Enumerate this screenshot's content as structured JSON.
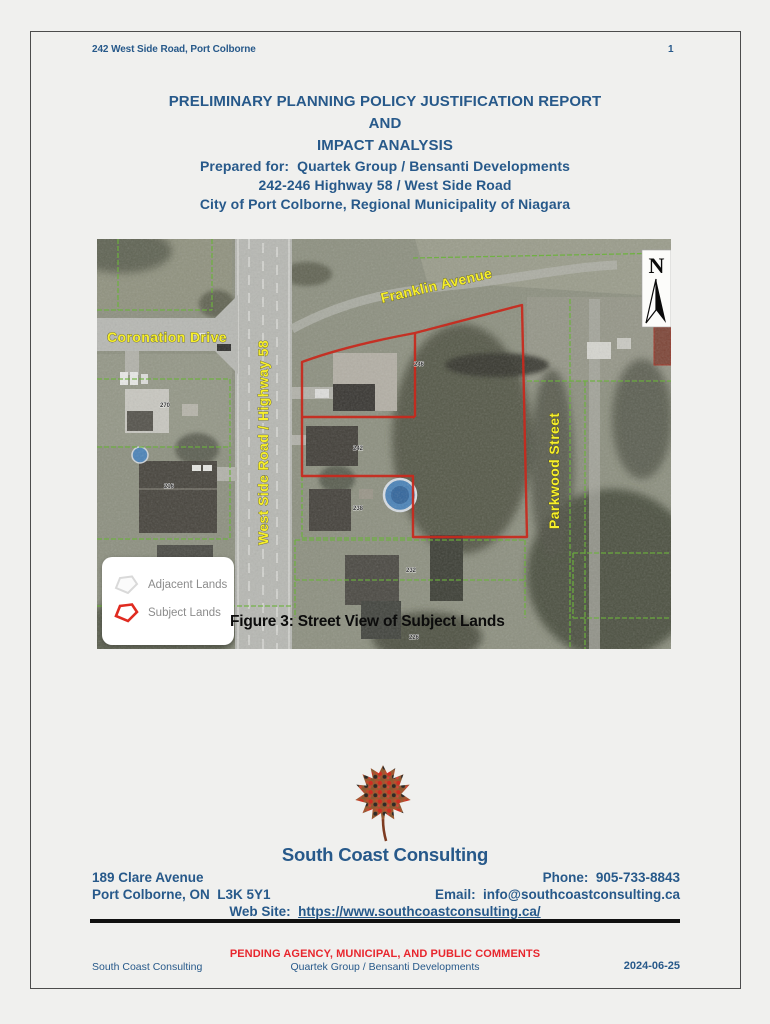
{
  "header": {
    "left": "242 West Side Road, Port Colborne",
    "page_number": "1"
  },
  "title_block": {
    "line1": "PRELIMINARY PLANNING POLICY JUSTIFICATION REPORT",
    "line2": "AND",
    "line3": "IMPACT ANALYSIS",
    "line4": "Prepared for:  Quartek Group / Bensanti Developments",
    "line5": "242-246 Highway 58 / West Side Road",
    "line6": "City of Port Colborne, Regional Municipality of Niagara"
  },
  "map": {
    "caption": "Figure 3: Street View of Subject Lands",
    "north_label": "N",
    "streets": {
      "coronation": "Coronation Drive",
      "west_side": "West Side Road / Highway 58",
      "franklin": "Franklin Avenue",
      "parkwood": "Parkwood Street"
    },
    "legend": {
      "adjacent": "Adjacent Lands",
      "subject": "Subject Lands"
    },
    "house_numbers": [
      "270",
      "216",
      "246",
      "242",
      "238",
      "232",
      "226"
    ],
    "colors": {
      "subject_outline": "#c9281c",
      "adjacent_outline": "#6cb23c",
      "street_label": "#f7ef2b"
    }
  },
  "company": {
    "name": "South Coast Consulting",
    "address_line1": "189 Clare Avenue",
    "address_line2": "Port Colborne, ON  L3K 5Y1",
    "phone": "Phone:  905-733-8843",
    "email": "Email:  info@southcoastconsulting.ca",
    "website_label": "Web Site:  ",
    "website_url": "https://www.southcoastconsulting.ca/"
  },
  "footer": {
    "status": "PENDING AGENCY, MUNICIPAL, AND PUBLIC COMMENTS",
    "left": "South Coast Consulting",
    "center": "Quartek Group / Bensanti Developments",
    "date": "2024-06-25"
  }
}
